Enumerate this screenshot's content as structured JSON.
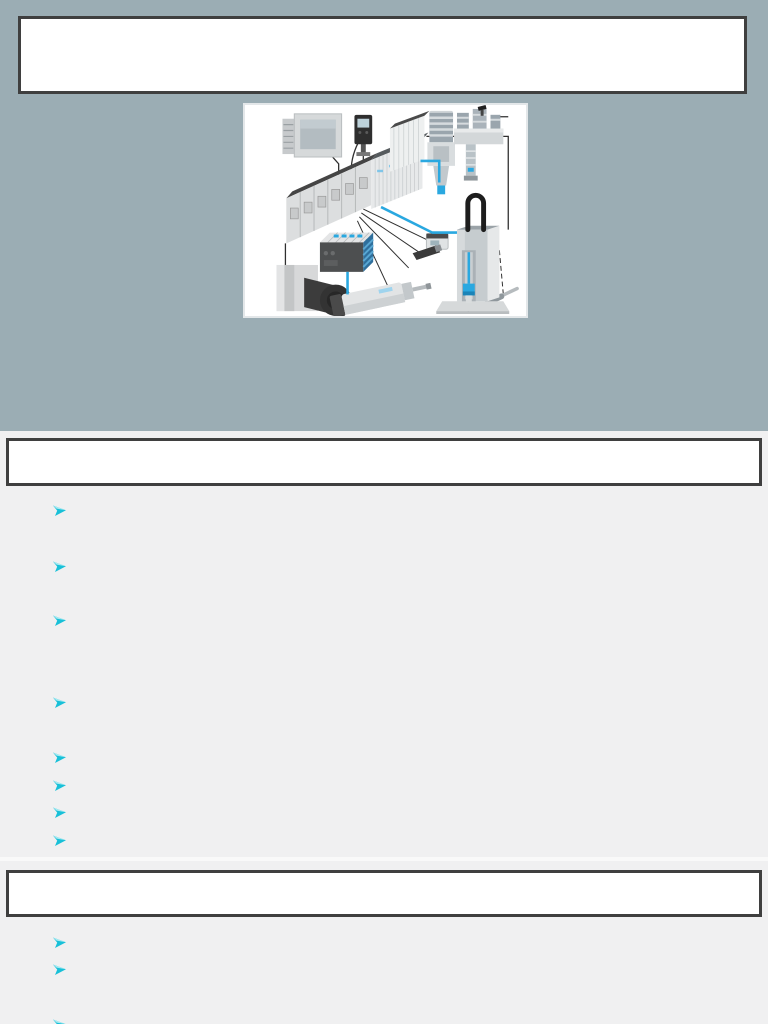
{
  "colors": {
    "top_background": "#9badb4",
    "content_background": "#f0f0f1",
    "box_border": "#3f3f3f",
    "box_fill": "#ffffff",
    "bullet_arrow": "#18c0d8",
    "tubing_blue": "#2aa8e0"
  },
  "icons": {
    "bullet_marker": "three-d-rightwards-arrowhead"
  },
  "title_box": {
    "text": ""
  },
  "hero_image": {
    "description": "modular industrial automation system: HMI panel, display sensor, modular I/O terminal, air preparation unit, motor, valve manifold, electric cylinder, sensors and vertical linear slide linked by black cables and blue pneumatic tubing"
  },
  "sections": [
    {
      "header_text": "",
      "bullets": [
        "",
        "",
        "",
        "",
        "",
        "",
        "",
        ""
      ]
    },
    {
      "header_text": "",
      "bullets": [
        "",
        "",
        ""
      ]
    }
  ]
}
